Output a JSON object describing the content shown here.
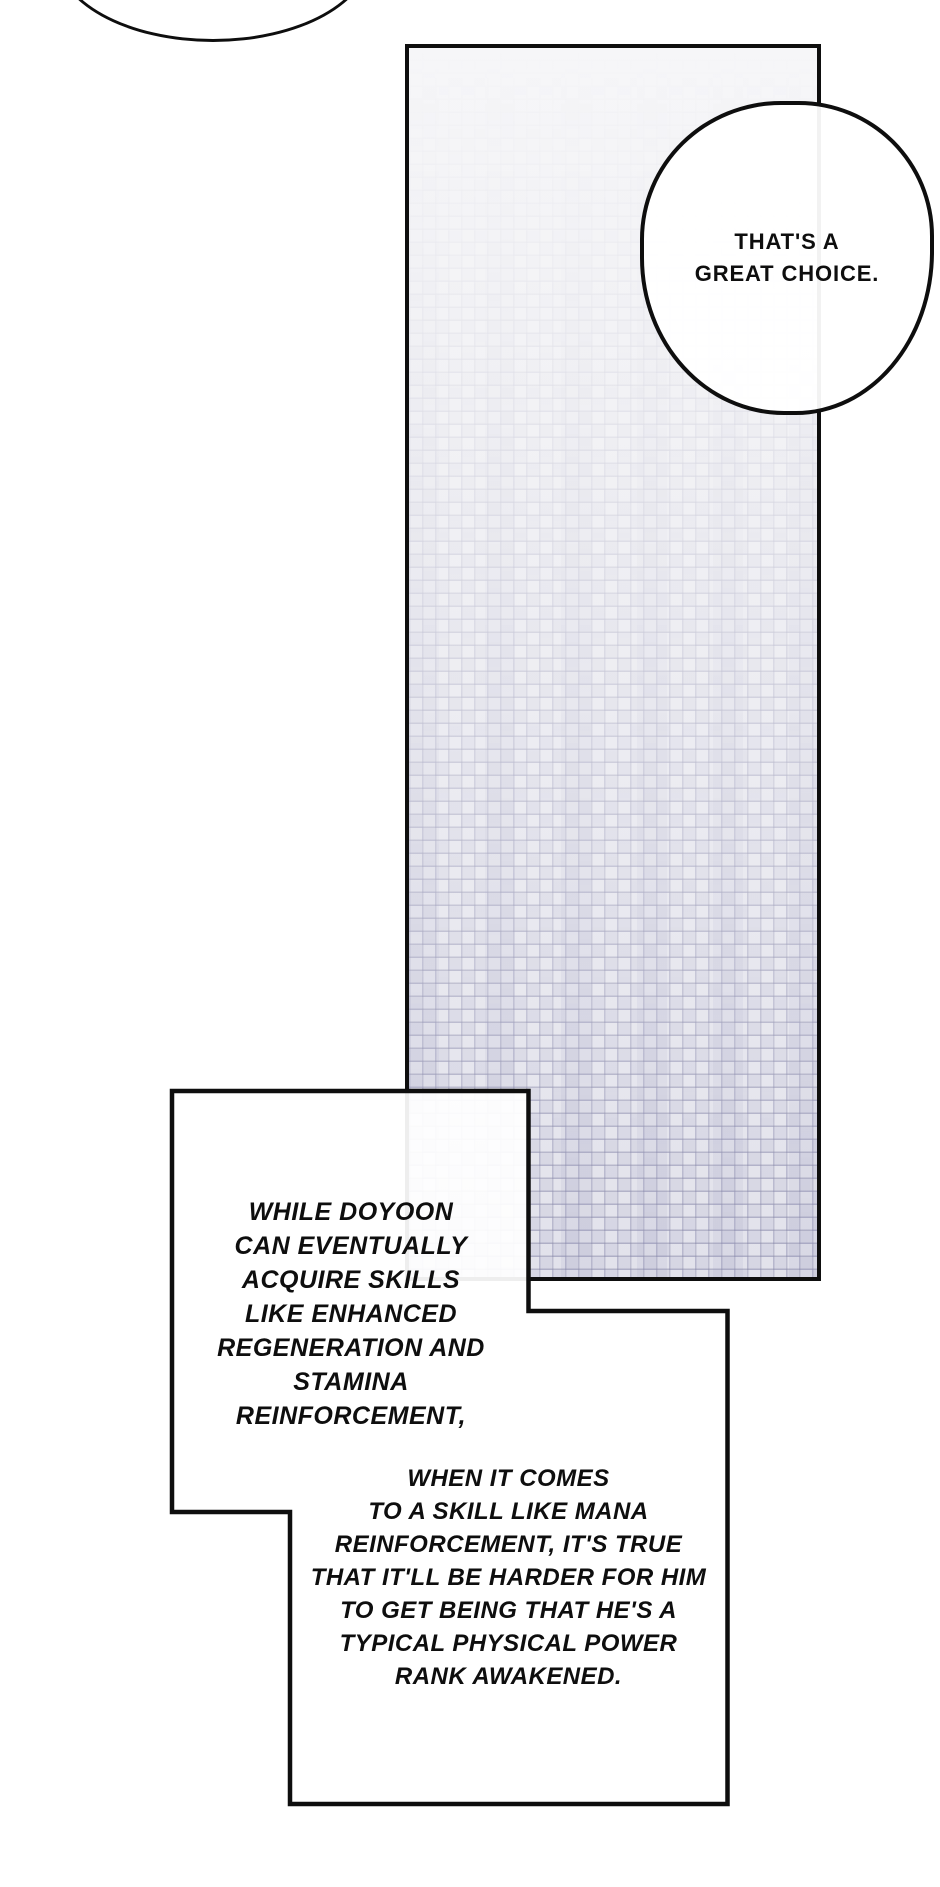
{
  "page": {
    "width_px": 940,
    "height_px": 1887,
    "background": "#ffffff"
  },
  "colors": {
    "ink": "#0e0e0e",
    "paper": "#ffffff",
    "panel-top": "#f6f6f8",
    "panel-bottom": "#e2e2eb"
  },
  "speech": {
    "choice_bubble": {
      "lines": [
        "THAT'S A",
        "GREAT CHOICE."
      ]
    },
    "caption_box_1": {
      "lines": [
        "WHILE DOYOON",
        "CAN EVENTUALLY",
        "ACQUIRE SKILLS",
        "LIKE ENHANCED",
        "REGENERATION AND",
        "STAMINA",
        "REINFORCEMENT,"
      ]
    },
    "caption_box_2": {
      "lines": [
        "WHEN IT COMES",
        "TO A SKILL LIKE MANA",
        "REINFORCEMENT, IT'S TRUE",
        "THAT IT'LL BE HARDER FOR HIM",
        "TO GET BEING THAT HE'S A",
        "TYPICAL PHYSICAL POWER",
        "RANK AWAKENED."
      ]
    }
  }
}
